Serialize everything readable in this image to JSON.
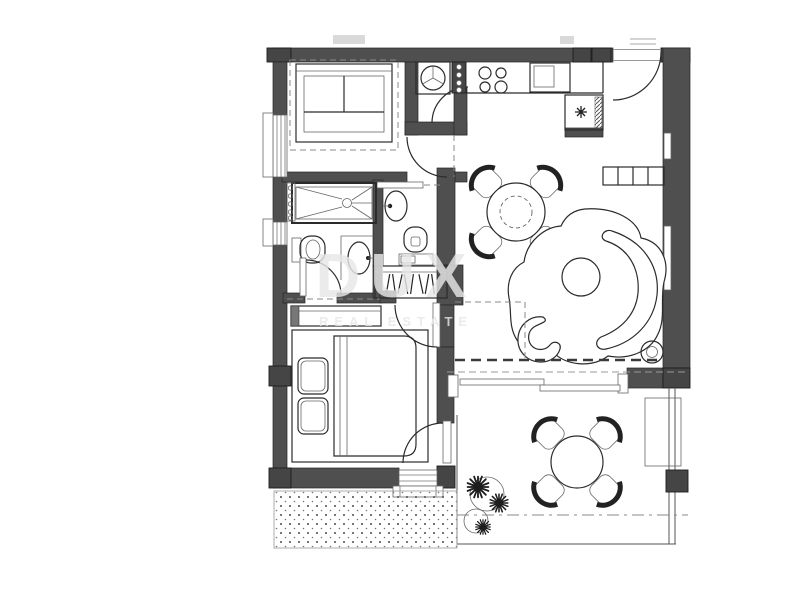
{
  "watermark": {
    "title": "DUX",
    "subtitle": "REAL ESTATE"
  },
  "palette": {
    "bg": "#ffffff",
    "wall": "#4f4f4f",
    "line": "#2b2b2b",
    "watermark": "#e7e7e7"
  },
  "symbols": {
    "plan": "apartment-floor-plan",
    "items": [
      "double-bed",
      "single-bed",
      "shower",
      "toilet",
      "bidet",
      "washbasin",
      "vanity-sink",
      "towel-radiator",
      "wardrobe-with-hangers",
      "washing-machine",
      "cooktop-burners",
      "kitchen-sink",
      "refrigerator",
      "sideboard",
      "dining-table-with-chairs",
      "organic-rug-sofa-set",
      "floor-lamp",
      "sliding-terrace-door",
      "terrace-table-with-chairs",
      "plants",
      "planter",
      "gravel-strip",
      "entry-door"
    ]
  }
}
